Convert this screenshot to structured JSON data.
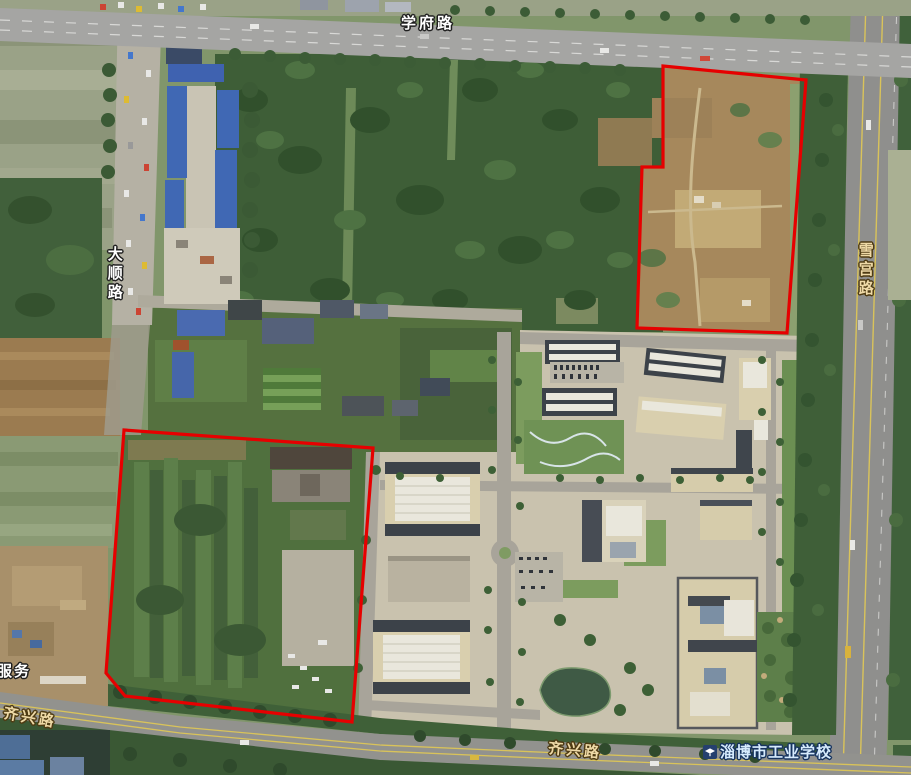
{
  "map": {
    "view": "satellite",
    "labels": {
      "xuefu_road": "学府路",
      "dashun_road": "大顺路",
      "xuegong_road": "雪宫路",
      "qixing_road_west": "齐兴路",
      "qixing_road_center": "齐兴路",
      "partial_poi_west": "服务",
      "school_poi": "淄博市工业学校"
    },
    "annotations": {
      "stroke_color": "#e60000",
      "stroke_width": 3.2,
      "polygons": [
        {
          "name": "parcel-northeast",
          "points": [
            [
              663,
              66
            ],
            [
              806,
              80
            ],
            [
              787,
              333
            ],
            [
              637,
              328
            ],
            [
              642,
              167
            ],
            [
              663,
              167
            ]
          ]
        },
        {
          "name": "parcel-southwest",
          "points": [
            [
              124,
              430
            ],
            [
              373,
              448
            ],
            [
              352,
              722
            ],
            [
              125,
              696
            ],
            [
              106,
              673
            ]
          ]
        }
      ]
    }
  }
}
